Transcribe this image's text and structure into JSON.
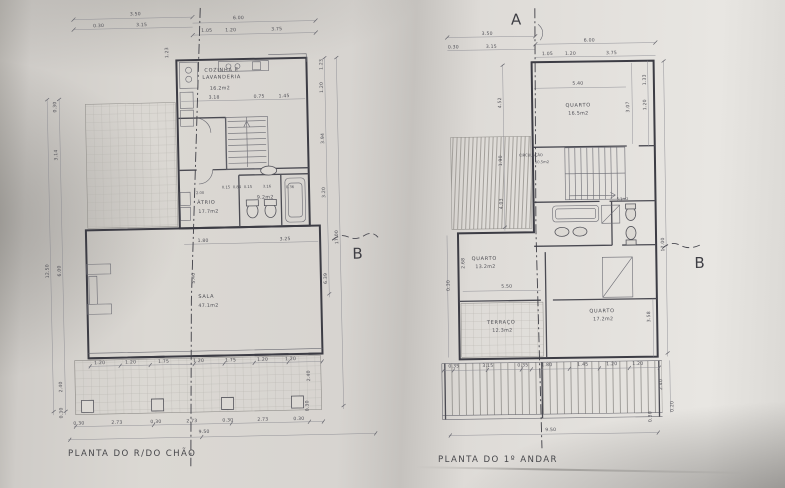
{
  "left_plan": {
    "title": "PLANTA DO R/DO CHÃO",
    "section_label": "B",
    "rooms": {
      "kitchen_line1": "COZINHA E",
      "kitchen_line2": "LAVANDERIA",
      "kitchen_area": "16.2m2",
      "atrio_name": "ÁTRIO",
      "atrio_area": "17.7m2",
      "bath_area": "9.2m2",
      "sala_name": "SALA",
      "sala_area": "47.1m2"
    },
    "dims": {
      "top": [
        "3.50",
        "6.00"
      ],
      "top2": [
        "0.30",
        "3.15",
        "1.05",
        "1.20",
        "3.75"
      ],
      "upper_left": "1.23",
      "left": [
        "0.30",
        "3.14",
        "12.50",
        "6.00",
        "2.40",
        "0.30"
      ],
      "right": [
        "1.23",
        "1.20",
        "3.94",
        "3.20",
        "17.00",
        "6.39"
      ],
      "kitchen": [
        "3.18",
        "0.75",
        "1.45"
      ],
      "atrio": [
        "2.00",
        "0.15",
        "0.84",
        "0.15",
        "3.16",
        "0.36"
      ],
      "sala": [
        "1.80",
        "3.25",
        "5.40"
      ],
      "bottom": [
        "1.20",
        "1.20",
        "1.75",
        "1.20",
        "1.75",
        "1.20",
        "1.20"
      ],
      "bottom2": [
        "0.30",
        "2.73",
        "0.30",
        "2.73",
        "0.30",
        "2.73",
        "0.30"
      ],
      "bottom_right": [
        "2.40",
        "0.30"
      ],
      "total": "9.50"
    }
  },
  "right_plan": {
    "title": "PLANTA DO 1º ANDAR",
    "section_label_top": "A",
    "section_label": "B",
    "rooms": {
      "quarto1_name": "QUARTO",
      "quarto1_area": "16.5m2",
      "circulacao_name": "CIRCULAÇÃO",
      "circulacao_area": "10.5m2",
      "bath_area": "5.1m2",
      "quarto2_name": "QUARTO",
      "quarto2_area": "13.2m2",
      "terraco_name": "TERRAÇO",
      "terraco_area": "12.3m2",
      "quarto3_name": "QUARTO",
      "quarto3_area": "17.2m2"
    },
    "dims": {
      "top": [
        "3.50",
        "6.00"
      ],
      "top2": [
        "0.30",
        "3.15",
        "1.05",
        "1.20",
        "3.75"
      ],
      "left": [
        "4.52",
        "1.90",
        "4.03"
      ],
      "left2": [
        "2.68",
        "0.30"
      ],
      "right": [
        "1.33",
        "1.20",
        "3.07",
        "17.00",
        "3.58"
      ],
      "right_bottom": [
        "2.40",
        "0.20",
        "0.30"
      ],
      "inner": [
        "5.40",
        "5.50"
      ],
      "bottom": [
        "0.35",
        "3.15",
        "0.35",
        "1.80",
        "1.45",
        "1.20",
        "1.20"
      ],
      "total": "9.50"
    }
  }
}
